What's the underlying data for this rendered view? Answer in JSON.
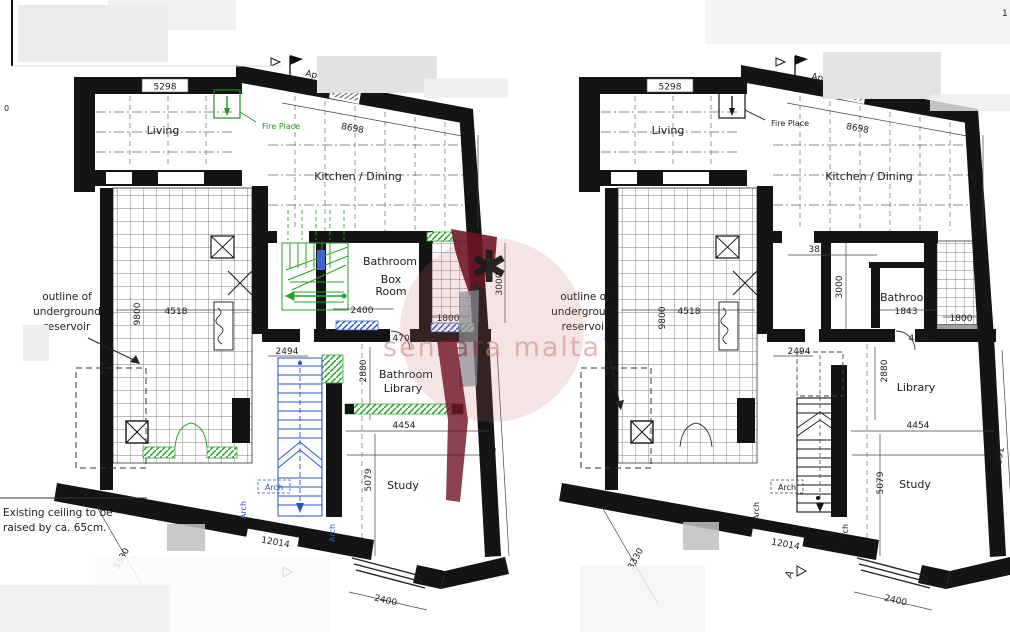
{
  "page": {
    "corner_mark": "1"
  },
  "watermark": {
    "part1": "sen",
    "part2": "sar",
    "part3": "a malta",
    "asterisk": "✱"
  },
  "plans": {
    "left": {
      "dims": {
        "d5298": "5298",
        "d8698": "8698",
        "d3623": "3623",
        "d3000": "3000",
        "d1800": "1800",
        "d2400_box": "2400",
        "d4706": "4706",
        "d2494": "2494",
        "d2880": "2880",
        "d4454": "4454",
        "d5079": "5079",
        "d8991": "8991",
        "d12014": "12014",
        "d2400": "2400",
        "d3330": "3330",
        "d4518": "4518",
        "d9800": "9800"
      },
      "rooms": {
        "living": "Living",
        "kitchen": "Kitchen / Dining",
        "bathroom": "Bathroom",
        "box_room_line1": "Box",
        "box_room_line2": "Room",
        "bath_library_line1": "Bathroom",
        "bath_library_line2": "Library",
        "study": "Study"
      },
      "labels": {
        "fireplace": "Fire Place",
        "arch": "Arch",
        "flag_text_start": "App",
        "flag_text_end": "ght of"
      },
      "notes": {
        "reservoir_line1": "outline of",
        "reservoir_line2": "underground",
        "reservoir_line3": "reservoir",
        "ceiling_line1": "Existing ceiling to be",
        "ceiling_line2": "raised by ca. 65cm.",
        "edge_mark": "0"
      }
    },
    "right": {
      "dims": {
        "d5298": "5298",
        "d8698": "8698",
        "d3623": "3623",
        "d3837": "3837",
        "d3000": "3000",
        "d1843": "1843",
        "d1800": "1800",
        "d4706": "4706",
        "d2494": "2494",
        "d2880": "2880",
        "d4454": "4454",
        "d5079": "5079",
        "d8991": "8991",
        "d12014": "12014",
        "d2400": "2400",
        "d3330": "3330",
        "d4518": "4518",
        "d9800": "9800"
      },
      "rooms": {
        "living": "Living",
        "kitchen": "Kitchen / Dining",
        "bathroom": "Bathroom",
        "library": "Library",
        "study": "Study"
      },
      "labels": {
        "fireplace": "Fire Place",
        "arch": "Arch",
        "flag_text_start": "Ap",
        "flag_text_end": "nt of s",
        "section_marker": "A"
      },
      "notes": {
        "reservoir_line1": "outline of",
        "reservoir_line2": "underground",
        "reservoir_line3": "reservoir"
      }
    }
  }
}
